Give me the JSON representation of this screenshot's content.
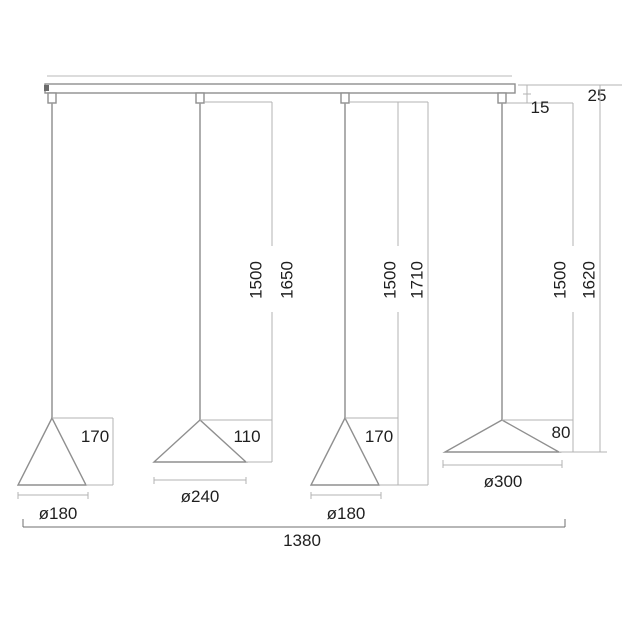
{
  "drawing": {
    "type": "technical-dimension-drawing",
    "subject": "four-cone linear pendant lamp",
    "colors": {
      "background": "#ffffff",
      "geometry_line": "#8f8f8f",
      "dimension_line": "#b3b3b3",
      "text": "#1f1f1f"
    },
    "top_dims": {
      "bar_height": "25",
      "grip_height": "15"
    },
    "drops": [
      {
        "cord": "1500",
        "total": "1650"
      },
      {
        "cord": "1500",
        "total": "1710"
      },
      {
        "cord": "1500",
        "total": "1620"
      }
    ],
    "shades": [
      {
        "height": "170",
        "diameter": "ø180"
      },
      {
        "height": "110",
        "diameter": "ø240"
      },
      {
        "height": "170",
        "diameter": "ø180"
      },
      {
        "height": "80",
        "diameter": "ø300"
      }
    ],
    "overall": {
      "width": "1380"
    }
  }
}
